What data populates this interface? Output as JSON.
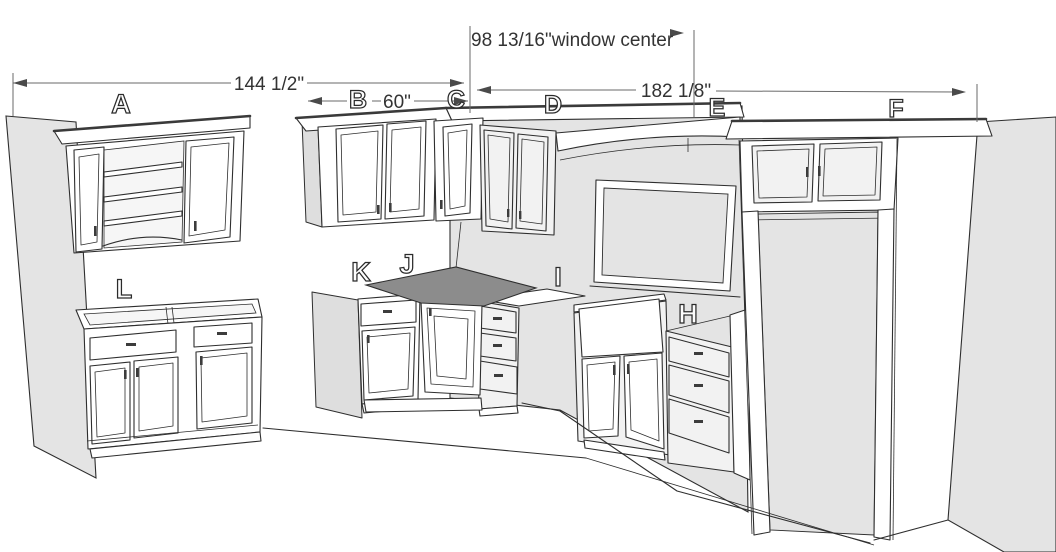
{
  "title": "Kitchen cabinet 3D layout drawing",
  "dimensions": {
    "window_center": "98 13/16\"window center",
    "left_run": "144 1/2\"",
    "cabinet_b": "60\"",
    "right_run": "182 1/8\""
  },
  "labels": {
    "a": "A",
    "b": "B",
    "c": "C",
    "d": "D",
    "e": "E",
    "f": "F",
    "h": "H",
    "i": "I",
    "j": "J",
    "k": "K",
    "l": "L"
  },
  "colors": {
    "wall": "#e4e4e4",
    "counter": "#8c8c8c",
    "line": "#2e2e2e",
    "dim_text": "#333333"
  }
}
